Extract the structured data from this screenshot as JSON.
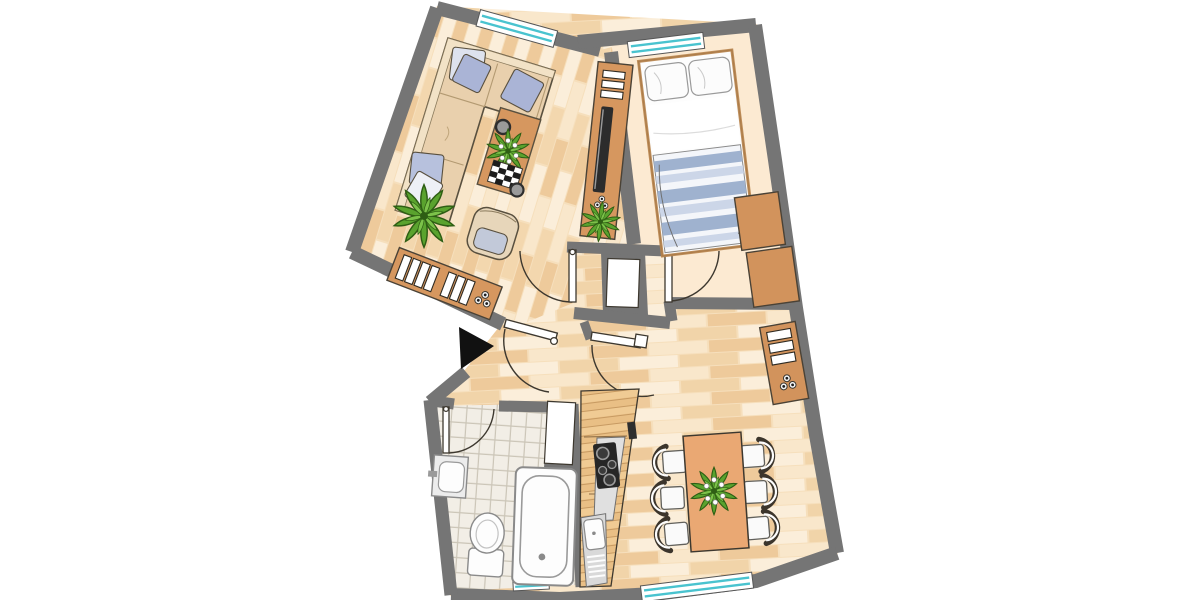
{
  "plan": {
    "type": "apartment-floor-plan",
    "background": "#ffffff",
    "colors": {
      "wall": "#757575",
      "outline": "#3d382f",
      "plank_a": "#fbeeda",
      "plank_b": "#f1d4a9",
      "plank_c": "#eeca9b",
      "plank_d": "#f9e7cb",
      "parquet_base": "#f6dfbc",
      "bedroom_floor": "#fcead2",
      "tile_floor": "#f2eee6",
      "tile_line": "#cbc5b7",
      "furniture_wood": "#d2935c",
      "cabinet_wood": "#e9bf85",
      "table_wood": "#eaa873",
      "sofa_beige": "#e9d0ad",
      "cushion_blue": "#aab4d6",
      "cushion_light": "#dde2ee",
      "bed_stripe": "#9fb2cf",
      "bed_stripe_light": "#ccd6e8",
      "window_glass": "#49c3cf",
      "fixture_white": "#fdfdfd",
      "fixture_line": "#8a8a8a",
      "appliance_gray": "#e0e0e0",
      "cooktop_black": "#262626",
      "tv_black": "#2c2c2c",
      "plant_green": "#5aa32e",
      "plant_green_dark": "#2e5e14",
      "plant_green_light": "#7cc24a",
      "arrow_black": "#111111"
    },
    "rooms": [
      {
        "name": "living-room",
        "floor": "wood-parquet-vertical",
        "furniture": [
          "corner-sofa",
          "throw-pillows",
          "coffee-table",
          "decor-bowl",
          "magazine-tray",
          "flower-arrangement",
          "armchair",
          "potted-plant",
          "sideboard-with-books",
          "tv-lowboard",
          "tv",
          "small-plant",
          "decor-knobs"
        ]
      },
      {
        "name": "bedroom",
        "floor": "plain-cream",
        "furniture": [
          "double-bed",
          "two-pillows",
          "striped-duvet",
          "wardrobe-upper",
          "wardrobe-lower"
        ]
      },
      {
        "name": "hallway",
        "floor": "wood-parquet",
        "furniture": [
          "built-in-niche"
        ]
      },
      {
        "name": "bathroom",
        "floor": "ceramic-tiles",
        "furniture": [
          "washbasin",
          "toilet",
          "bathtub",
          "wall-niche"
        ]
      },
      {
        "name": "kitchen-dining",
        "floor": "wood-parquet",
        "furniture": [
          "kitchen-counter",
          "cooktop-4-burners",
          "kitchen-sink-with-drainer",
          "dining-table",
          "dining-chairs-x6",
          "plant-centerpiece",
          "sideboard-with-drawers",
          "decor-knobs"
        ]
      }
    ],
    "openings": {
      "entrance_door": 1,
      "interior_doors": 4,
      "windows": 4,
      "entrance_marker": "black-arrow"
    }
  }
}
